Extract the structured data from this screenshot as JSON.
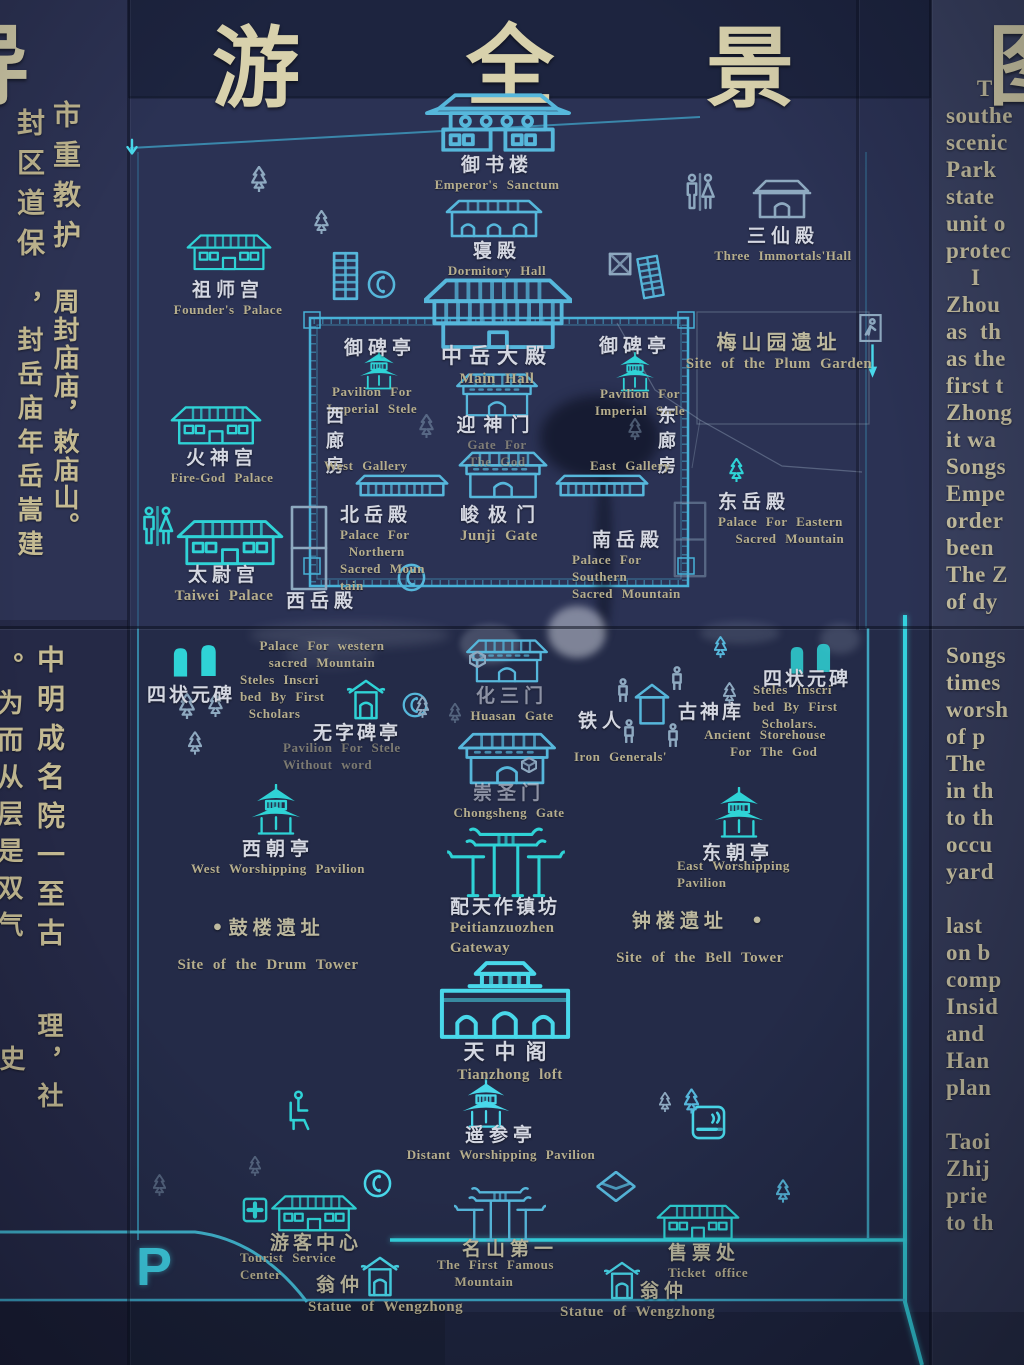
{
  "title": {
    "partial_left": "导",
    "char1": "游",
    "char2": "全",
    "char3": "景",
    "partial_right": "图"
  },
  "left_panel": {
    "s1_colA1": "市重教护",
    "s1_colA2": "周封庙庙，敕庙山。",
    "s1_colB1": "封区道保",
    "s1_colB2": "，封岳庙年岳嵩建",
    "s2_colA1": "中明成名院一至古",
    "s2_colA2": "理，社",
    "s2_colB1": "。为而从层是双气",
    "s2_colB2": "史"
  },
  "right_panel": {
    "lines": [
      "     T",
      "southe",
      "scenic",
      "Park",
      "state",
      "unit o",
      "protec",
      "    I",
      "Zhou",
      "as  th",
      "as the",
      "first t",
      "Zhong",
      "it wa",
      "Songs",
      "Empe",
      "order",
      "been",
      "The Z",
      "of dy",
      "",
      "Songs",
      "times",
      "worsh",
      "of p",
      "The",
      "in th",
      "to th",
      "occu",
      "yard",
      "",
      "last",
      "on b",
      "comp",
      "Insid",
      "and",
      "Han",
      "plan",
      "",
      "Taoi",
      "Zhij",
      "prie",
      "to th"
    ]
  },
  "map": {
    "parking_label": "P",
    "sites": [
      {
        "id": "yushulou",
        "cn": "御书楼",
        "en": "Emperor's Sanctum",
        "icon": "two-tier-hall"
      },
      {
        "id": "qindian",
        "cn": "寝殿",
        "en": "Dormitory Hall",
        "icon": "three-bay-hall"
      },
      {
        "id": "zushigong",
        "cn": "祖师宫",
        "en": "Founder's Palace",
        "icon": "hall"
      },
      {
        "id": "sanxiandian",
        "cn": "三仙殿",
        "en": "Three Immortals'Hall",
        "icon": "small-hall"
      },
      {
        "id": "meishanyuan",
        "cn": "梅山园遗址",
        "en": "Site of the Plum Garden",
        "icon": "site-outline"
      },
      {
        "id": "yubeiting-west",
        "cn": "御碑亭",
        "en": "Pavilion For\nImperial Stele",
        "icon": "pavilion"
      },
      {
        "id": "zhongyuedadian",
        "cn": "中岳大殿",
        "en": "Main Hall",
        "icon": "great-hall"
      },
      {
        "id": "yubeiting-east",
        "cn": "御碑亭",
        "en": "Pavilion For\nImperial Stele",
        "icon": "pavilion"
      },
      {
        "id": "yingshenmen",
        "cn": "迎神门",
        "en": "Gate For\nThe God",
        "icon": "gate"
      },
      {
        "id": "xilangfang",
        "cn": "西廊房",
        "en": "West Gallery",
        "icon": "gallery-wall"
      },
      {
        "id": "donglangfang",
        "cn": "东廊房",
        "en": "East Gallery",
        "icon": "gallery-wall"
      },
      {
        "id": "huoshengong",
        "cn": "火神宫",
        "en": "Fire-God Palace",
        "icon": "hall"
      },
      {
        "id": "beiyuedian",
        "cn": "北岳殿",
        "en": "Palace For\n Northern\nSacred Moun\ntain",
        "icon": "site-box"
      },
      {
        "id": "junjimen",
        "cn": "峻极门",
        "en": "Junji Gate",
        "icon": "gate"
      },
      {
        "id": "dongyuedian",
        "cn": "东岳殿",
        "en": "Palace For Eastern\n  Sacred Mountain",
        "icon": "site-box"
      },
      {
        "id": "taiweigong",
        "cn": "太尉宫",
        "en": "Taiwei Palace",
        "icon": "hall"
      },
      {
        "id": "xiyuedian",
        "cn": "西岳殿",
        "en": "Palace For western\nsacred Mountain",
        "icon": "site-box"
      },
      {
        "id": "nanyuedian",
        "cn": "南岳殿",
        "en": "Palace For\nSouthern\nSacred Mountain",
        "icon": "site-box"
      },
      {
        "id": "sizhuangyuanbei-west",
        "cn": "四状元碑",
        "en": "Steles Inscri\nbed By First\n Scholars",
        "icon": "stele-pair"
      },
      {
        "id": "wuzibeiting",
        "cn": "无字碑亭",
        "en": "Pavilion For Stele\nWithout word",
        "icon": "stele-pavilion"
      },
      {
        "id": "huasanmen",
        "cn": "化三门",
        "en": "Huasan Gate",
        "icon": "gate"
      },
      {
        "id": "tieren",
        "cn": "铁人",
        "en": "Iron Generals'",
        "icon": "iron-figures"
      },
      {
        "id": "gushenku",
        "cn": "古神库",
        "en": "Ancient Storehouse\n  For The God",
        "icon": "canopy"
      },
      {
        "id": "sizhuangyuanbei-east",
        "cn": "四状元碑",
        "en": "Steles Inscri\nbed By First\n Scholars.",
        "icon": "stele-pair"
      },
      {
        "id": "chongshengmen",
        "cn": "崇圣门",
        "en": "Chongsheng Gate",
        "icon": "gate"
      },
      {
        "id": "xichaoting",
        "cn": "西朝亭",
        "en": "West Worshipping Pavilion",
        "icon": "pagoda-pavilion"
      },
      {
        "id": "dongchaoting",
        "cn": "东朝亭",
        "en": "East Worshipping\nPavilion",
        "icon": "pagoda-pavilion"
      },
      {
        "id": "gulouyizhi",
        "cn": "•鼓楼遗址",
        "en": "Site of the Drum Tower",
        "icon": "ruin-site"
      },
      {
        "id": "zhonglouyizhi",
        "cn": "钟楼遗址  •",
        "en": "Site of the Bell Tower",
        "icon": "ruin-site"
      },
      {
        "id": "peitianzuozhenfang",
        "cn": "配天作镇坊",
        "en": "Peitianzuozhen\nGateway",
        "icon": "paifang-archway"
      },
      {
        "id": "tianzhongge",
        "cn": "天中阁",
        "en": "Tianzhong loft",
        "icon": "city-gate"
      },
      {
        "id": "yaocanting",
        "cn": "遥参亭",
        "en": "Distant Worshipping Pavilion",
        "icon": "pagoda-pavilion"
      },
      {
        "id": "youkezhongxin",
        "cn": "游客中心",
        "en": "Tourist Service\nCenter",
        "icon": "hall"
      },
      {
        "id": "mingshandiyi",
        "cn": "名山第一",
        "en": "The First Famous\n  Mountain",
        "icon": "paifang-archway"
      },
      {
        "id": "shoupiaochu",
        "cn": "售票处",
        "en": "Ticket office",
        "icon": "hall"
      },
      {
        "id": "wengzhong-west",
        "cn": "翁仲",
        "en": "Statue of Wengzhong",
        "icon": "shrine"
      },
      {
        "id": "wengzhong-east",
        "cn": "翁仲",
        "en": "Statue of Wengzhong",
        "icon": "shrine"
      }
    ]
  },
  "colors": {
    "background_navy": "#2b3254",
    "line_blue": "#56b7db",
    "bright_teal": "#2fd3d6",
    "label_white": "#d4d7e1",
    "english_khaki": "#b6ae8d",
    "title_gold": "#d8d1ac"
  }
}
